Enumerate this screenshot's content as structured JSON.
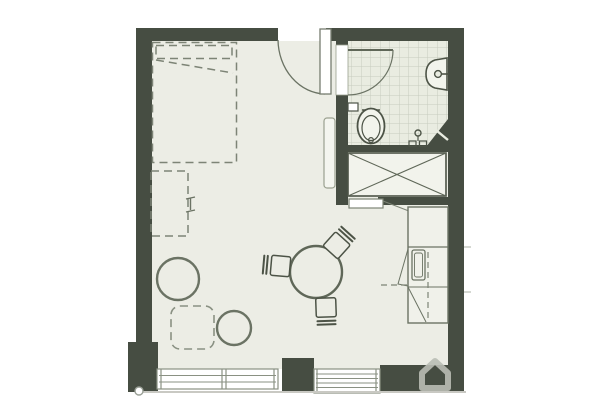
{
  "meta": {
    "type": "floor-plan"
  },
  "colors": {
    "background": "#ffffff",
    "wall": "#464d42",
    "floor": "#ecede5",
    "bathroom_floor": "#e9ece1",
    "tile_line": "#c6ccbe",
    "furniture_line": "#6b7364",
    "dashed_line": "#7d8476",
    "window_line": "#8a9183",
    "ground_line": "#c9c9c3",
    "watermark": "#b9bdb4"
  },
  "rooms": [
    "main-room",
    "bathroom",
    "closet"
  ],
  "fixtures": [
    "bed-dashed-outline",
    "pillow",
    "fold-down-desk-dashed",
    "pouf",
    "pouf",
    "side-table-dashed",
    "dining-table",
    "chair",
    "chair",
    "chair",
    "entry-door",
    "bathroom-door",
    "radiator",
    "toilet",
    "toilet-paper-holder",
    "wash-basin",
    "shower-controls",
    "corner-shower-wedge",
    "wardrobe-closet",
    "closet-door",
    "kitchen-unit",
    "window",
    "window",
    "ground-line-marker",
    "house-watermark-icon"
  ]
}
